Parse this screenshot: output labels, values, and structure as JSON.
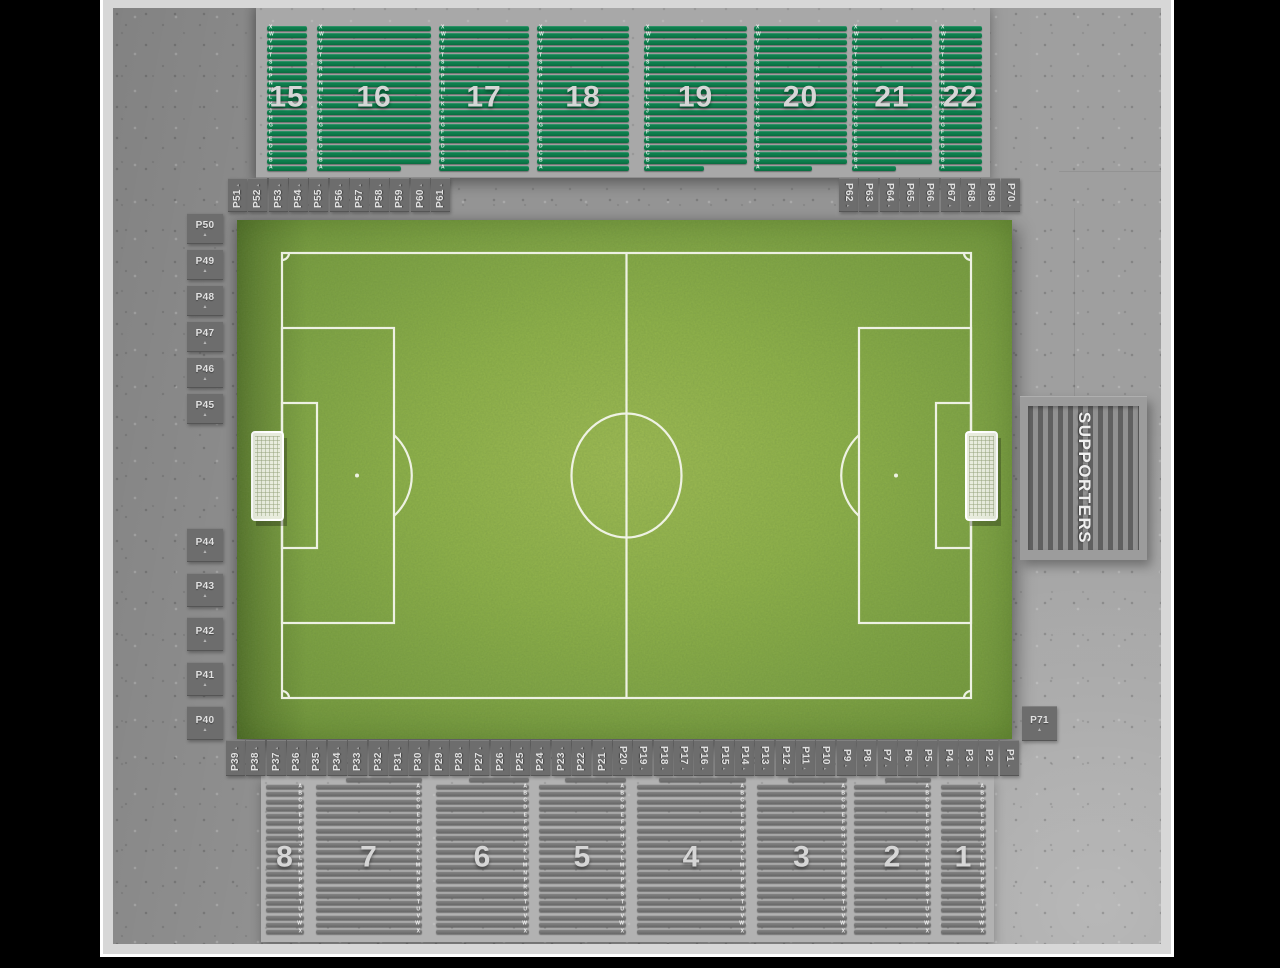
{
  "viewer": {
    "background": "#000000"
  },
  "map": {
    "top_stand": {
      "sections": [
        {
          "label": "15"
        },
        {
          "label": "16"
        },
        {
          "label": "17"
        },
        {
          "label": "18"
        },
        {
          "label": "19"
        },
        {
          "label": "20"
        },
        {
          "label": "21"
        },
        {
          "label": "22"
        }
      ],
      "row_letters_top_to_bottom": [
        "X",
        "W",
        "V",
        "U",
        "T",
        "S",
        "R",
        "P",
        "N",
        "M",
        "L",
        "K",
        "J",
        "H",
        "G",
        "F",
        "E",
        "D",
        "C",
        "B",
        "A"
      ]
    },
    "bottom_stand": {
      "sections": [
        {
          "label": "8"
        },
        {
          "label": "7"
        },
        {
          "label": "6"
        },
        {
          "label": "5"
        },
        {
          "label": "4"
        },
        {
          "label": "3"
        },
        {
          "label": "2"
        },
        {
          "label": "1"
        }
      ],
      "row_letters_top_to_bottom": [
        "A",
        "B",
        "C",
        "D",
        "E",
        "F",
        "G",
        "H",
        "J",
        "K",
        "L",
        "M",
        "N",
        "P",
        "R",
        "S",
        "T",
        "U",
        "V",
        "W",
        "X"
      ]
    },
    "supporters": {
      "label": "SUPPORTERS"
    },
    "gates": {
      "top_left": [
        "P51",
        "P52",
        "P53",
        "P54",
        "P55",
        "P56",
        "P57",
        "P58",
        "P59",
        "P60",
        "P61"
      ],
      "top_right": [
        "P62",
        "P63",
        "P64",
        "P65",
        "P66",
        "P67",
        "P68",
        "P69",
        "P70"
      ],
      "left_upper": [
        "P50",
        "P49",
        "P48",
        "P47",
        "P46",
        "P45"
      ],
      "left_lower": [
        "P44",
        "P43",
        "P42",
        "P41",
        "P40"
      ],
      "bottom": [
        "P39",
        "P38",
        "P37",
        "P36",
        "P35",
        "P34",
        "P33",
        "P32",
        "P31",
        "P30",
        "P29",
        "P28",
        "P27",
        "P26",
        "P25",
        "P24",
        "P23",
        "P22",
        "P21",
        "P20",
        "P19",
        "P18",
        "P17",
        "P16",
        "P15",
        "P14",
        "P13",
        "P12",
        "P11",
        "P10",
        "P9",
        "P8",
        "P7",
        "P6",
        "P5",
        "P4",
        "P3",
        "P2",
        "P1"
      ],
      "right": [
        "P71"
      ]
    },
    "colors": {
      "seat_green": "#0d7b4b",
      "seat_grey": "#777777",
      "grass_mid": "#8fb045",
      "concrete": "#949494",
      "gate_box": "#6d6d6d",
      "pitch_line": "#f4f6ec"
    }
  }
}
